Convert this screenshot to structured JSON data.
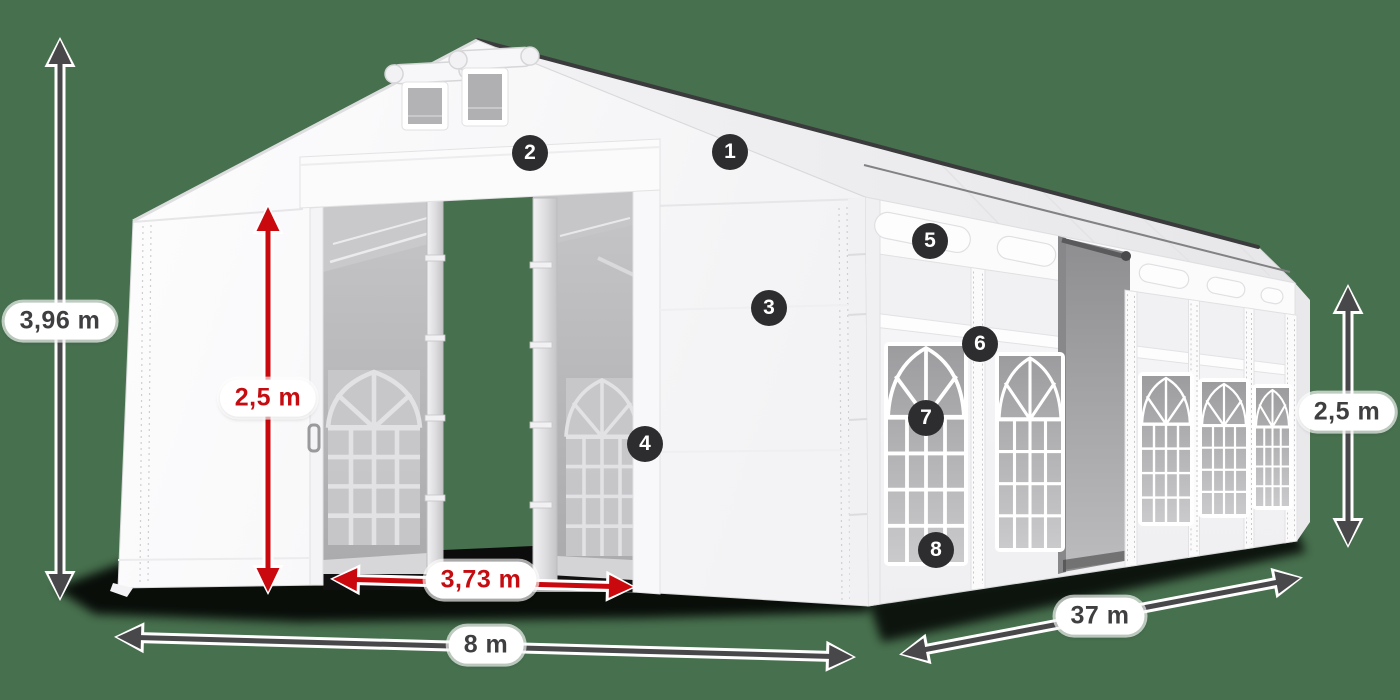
{
  "title": "Storage tent technical diagram",
  "background_color": "#47704E",
  "colors": {
    "annotation_dark": "#48484a",
    "annotation_red": "#c9090e",
    "badge_background": "#2d2d2f",
    "badge_text": "#ffffff",
    "pill_background": "#ffffff",
    "tent_white": "#f8f8fa",
    "interior_gray": "#b9b9bb",
    "shadow_black": "#000000"
  },
  "callouts": [
    "1",
    "2",
    "3",
    "4",
    "5",
    "6",
    "7",
    "8"
  ],
  "dimensions": {
    "total_height": "3,96 m",
    "entrance_height": "2,5 m",
    "entrance_width": "3,73 m",
    "tent_width": "8 m",
    "tent_length": "37 m",
    "side_wall_height": "2,5 m"
  }
}
